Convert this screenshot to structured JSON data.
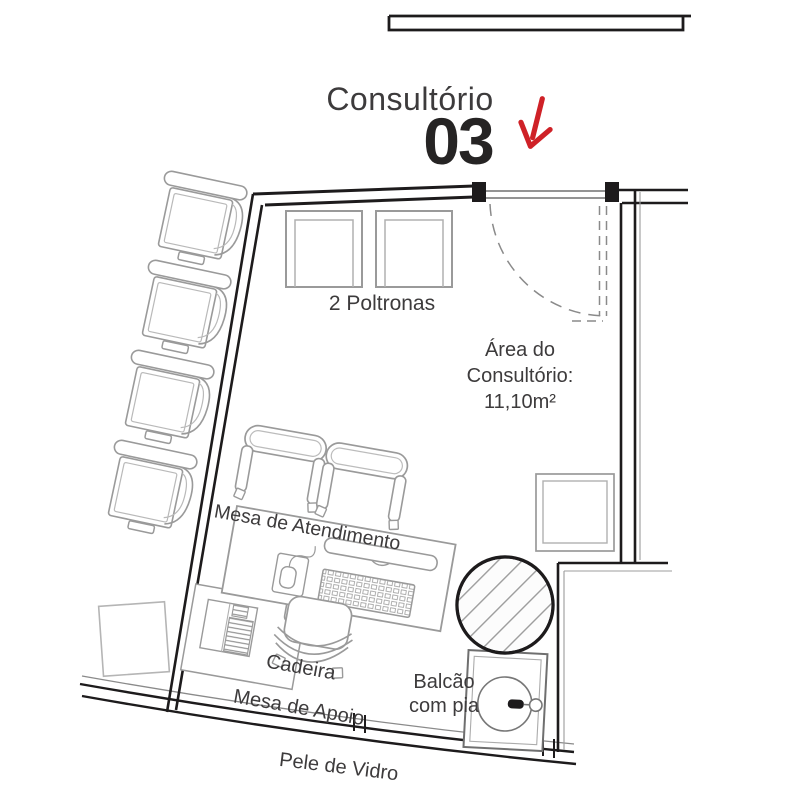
{
  "title": {
    "name": "Consultório",
    "number": "03"
  },
  "icons": {
    "entrance_arrow": "arrow-down-red"
  },
  "labels": {
    "poltronas": "2 Poltronas",
    "area_line1": "Área do",
    "area_line2": "Consultório:",
    "area_line3": "11,10m²",
    "mesa_atendimento": "Mesa de Atendimento",
    "cadeira": "Cadeira",
    "mesa_apoio": "Mesa de Apoio",
    "balcao_line1": "Balcão",
    "balcao_line2": "com pia",
    "pele_vidro": "Pele de Vidro"
  },
  "colors": {
    "accent": "#cf2127",
    "ink": "#3d3b3c",
    "wall": "#1d1b1c",
    "furniture": "#9a9a9a"
  }
}
